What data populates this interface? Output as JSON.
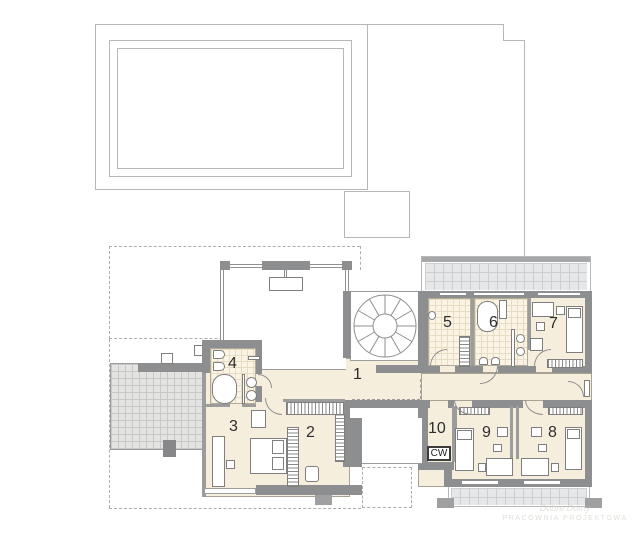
{
  "document": {
    "title": "floor-plan"
  },
  "labels": {
    "r1": "1",
    "r2": "2",
    "r3": "3",
    "r4": "4",
    "r5": "5",
    "r6": "6",
    "r7": "7",
    "r8": "8",
    "r9": "9",
    "r10": "10",
    "cw": "CW"
  },
  "watermark": {
    "line1": "Dobre Domy",
    "line2": "PRACOWNIA PROJEKTOWA"
  },
  "colors": {
    "floor": "#f6eedd",
    "wall": "#8d8e90",
    "tile": "#fbf4e4",
    "terrace": "#e6e7e9",
    "terrace_left": "#e3e3e1",
    "outline": "#b7b7b7",
    "label_text": "#2e2e2e"
  }
}
